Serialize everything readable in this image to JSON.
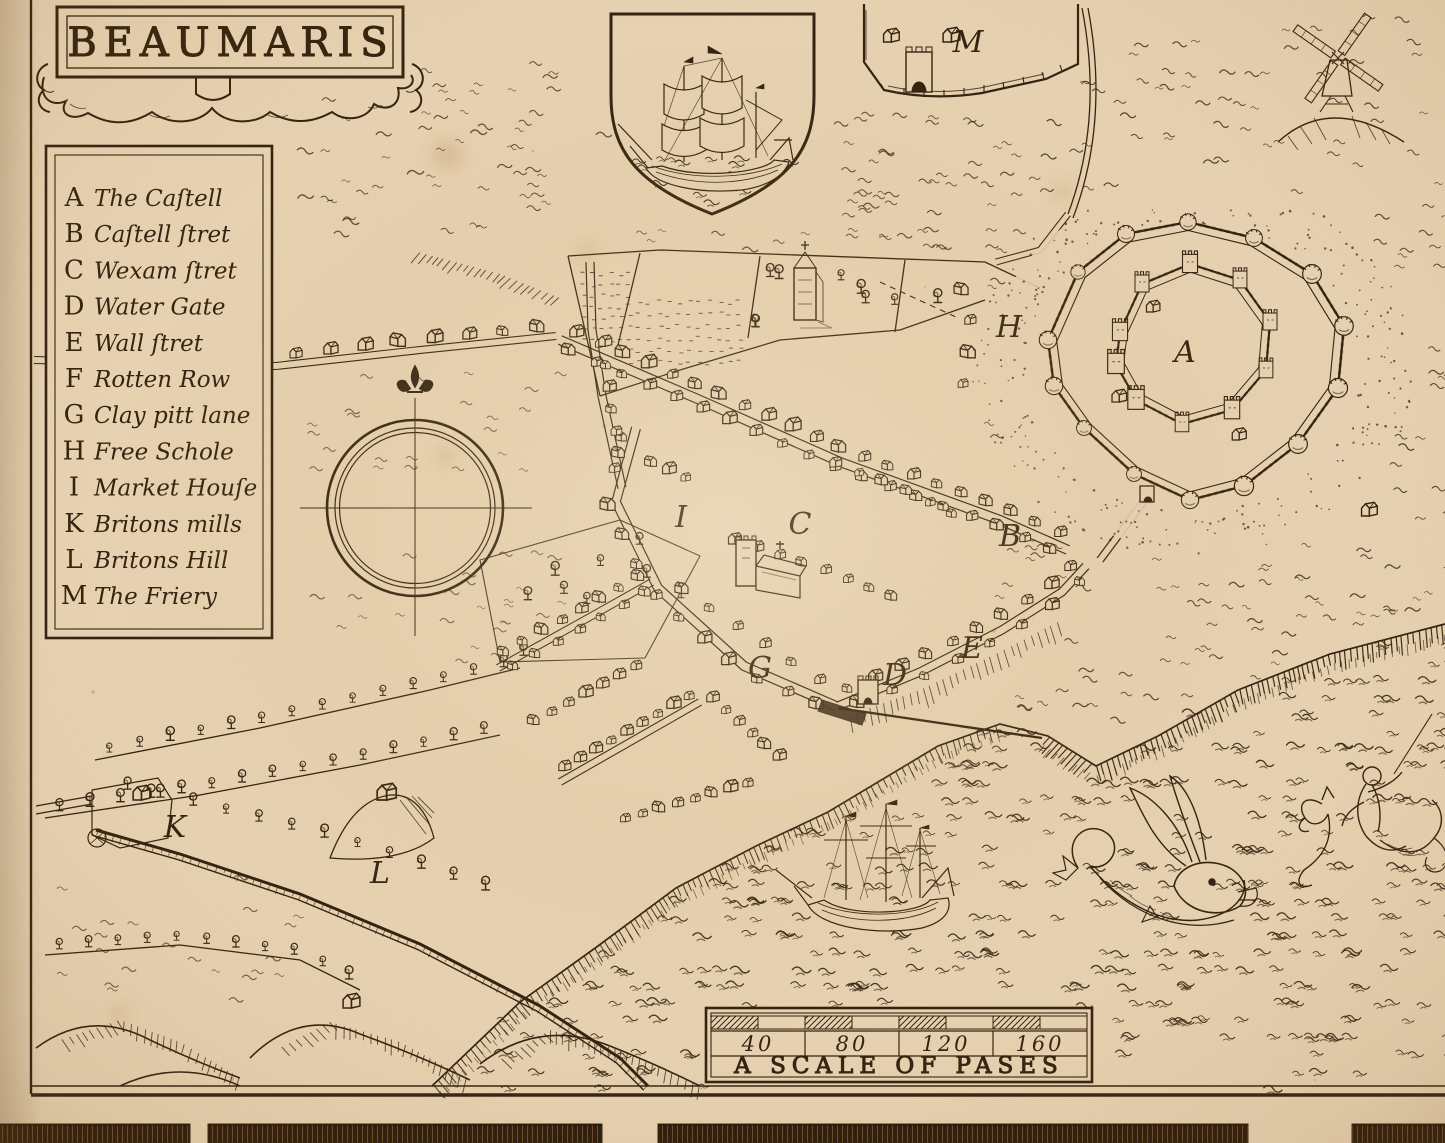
{
  "title": "BEAUMARIS",
  "legend": {
    "items": [
      {
        "letter": "A",
        "label": "The Caſtell"
      },
      {
        "letter": "B",
        "label": "Caſtell ſtret"
      },
      {
        "letter": "C",
        "label": "Wexam ſtret"
      },
      {
        "letter": "D",
        "label": "Water Gate"
      },
      {
        "letter": "E",
        "label": "Wall ſtret"
      },
      {
        "letter": "F",
        "label": "Rotten Row"
      },
      {
        "letter": "G",
        "label": "Clay pitt lane"
      },
      {
        "letter": "H",
        "label": "Free Schole"
      },
      {
        "letter": "I",
        "label": "Market Houſe"
      },
      {
        "letter": "K",
        "label": "Britons mills"
      },
      {
        "letter": "L",
        "label": "Britons Hill"
      },
      {
        "letter": "M",
        "label": "The Friery"
      }
    ]
  },
  "markers": [
    {
      "letter": "A",
      "x": 1185,
      "y": 352
    },
    {
      "letter": "B",
      "x": 1010,
      "y": 536
    },
    {
      "letter": "C",
      "x": 800,
      "y": 524
    },
    {
      "letter": "D",
      "x": 895,
      "y": 675
    },
    {
      "letter": "E",
      "x": 972,
      "y": 648
    },
    {
      "letter": "G",
      "x": 760,
      "y": 668
    },
    {
      "letter": "H",
      "x": 1009,
      "y": 327
    },
    {
      "letter": "I",
      "x": 681,
      "y": 517
    },
    {
      "letter": "K",
      "x": 175,
      "y": 827
    },
    {
      "letter": "L",
      "x": 380,
      "y": 873
    },
    {
      "letter": "M",
      "x": 968,
      "y": 42
    }
  ],
  "scale_bar": {
    "tick_labels": [
      "40",
      "80",
      "120",
      "160"
    ],
    "caption": "A SCALE OF PASES"
  },
  "colors": {
    "paper": "#e7d2b2",
    "ink": "#32220f"
  }
}
